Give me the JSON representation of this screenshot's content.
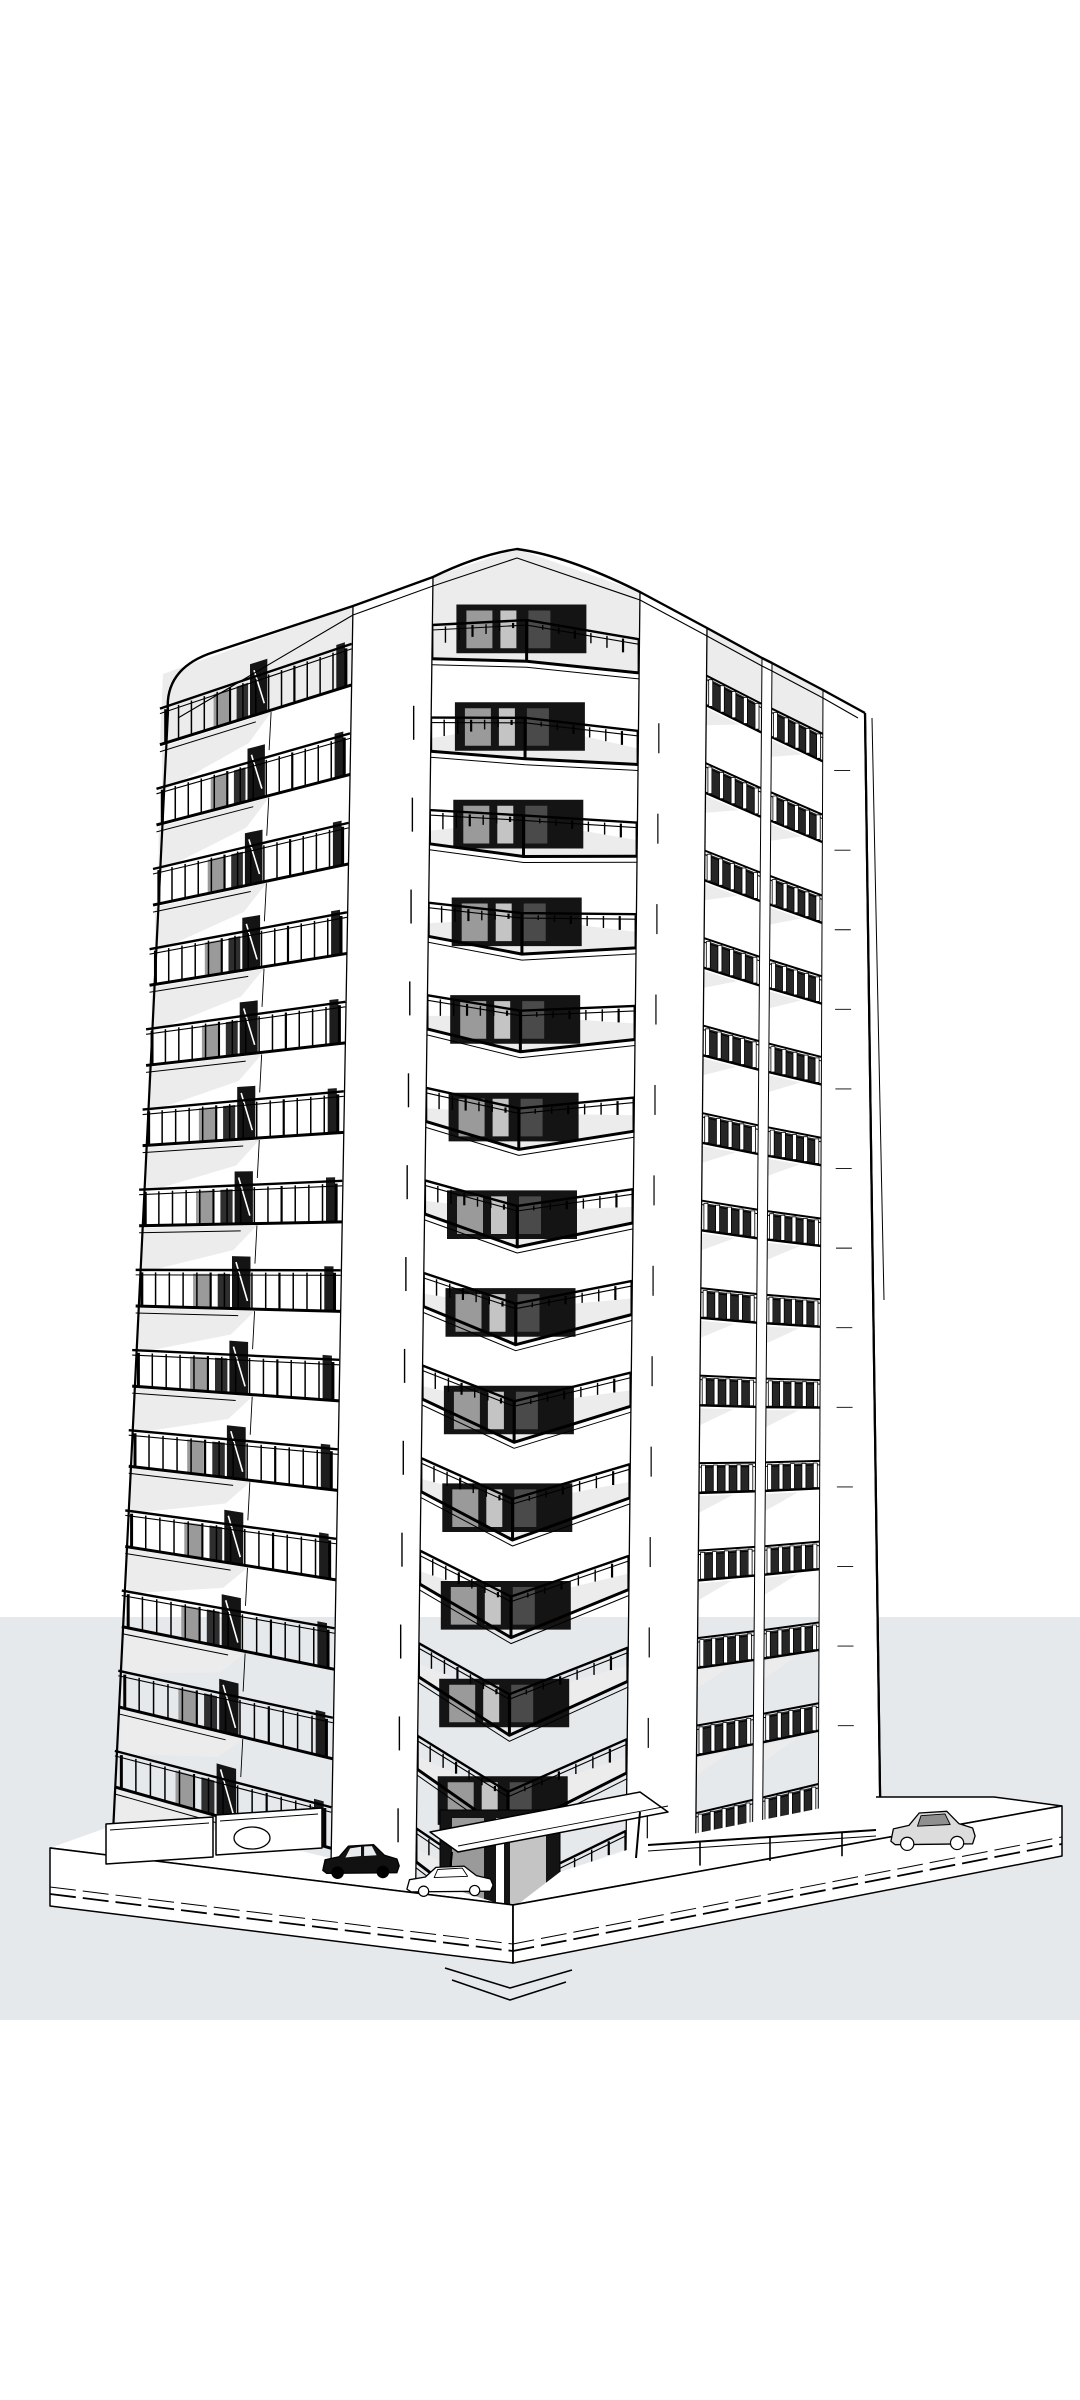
{
  "scene": {
    "canvas": {
      "w": 1080,
      "h": 2400
    },
    "colors": {
      "background": "#ffffff",
      "band": "#e5e9ec",
      "line": "#000000",
      "shade": "#ececec",
      "glass_light": "#9a9a9a",
      "glass_mid": "#c4c4c4",
      "glass_dark": "#4a4a4a",
      "window_black": "#141414",
      "backdrop_dark": "#262626",
      "car_dark": "#111111",
      "car_light": "#dcdcdc",
      "white": "#ffffff"
    },
    "band": {
      "top": 1617,
      "bottom": 2020
    },
    "floors": {
      "count": 14,
      "t0": 0.06,
      "dt": 0.068
    },
    "zones": {
      "A": {
        "top": [
          163,
          674
        ],
        "bot": [
          112,
          1853
        ]
      },
      "B": {
        "top": [
          353,
          606
        ],
        "bot": [
          330,
          1922
        ]
      },
      "C": {
        "top": [
          433,
          577
        ],
        "bot": [
          415,
          1938
        ]
      },
      "X": {
        "top": [
          528,
          549
        ],
        "bot": [
          505,
          1985
        ]
      },
      "D": {
        "top": [
          640,
          592
        ],
        "bot": [
          625,
          1940
        ]
      },
      "E": {
        "top": [
          707,
          628
        ],
        "bot": [
          695,
          1915
        ]
      },
      "F": {
        "top": [
          762,
          658
        ],
        "bot": [
          752,
          1898
        ]
      },
      "G": {
        "top": [
          772,
          663
        ],
        "bot": [
          762,
          1895
        ]
      },
      "H": {
        "top": [
          823,
          690
        ],
        "bot": [
          818,
          1878
        ]
      },
      "I": {
        "top": [
          865,
          713
        ],
        "bot": [
          881,
          1862
        ]
      }
    },
    "left_face": {
      "balusters": 15,
      "rail_h": 0.45,
      "pane": [
        0.28,
        0.36
      ],
      "dark_pane": [
        0.4,
        0.46
      ],
      "door": [
        0.47,
        0.56
      ],
      "sliver": [
        0.92,
        0.965
      ],
      "shade_u": 0.58,
      "joint_u": 0.58
    },
    "chevron": {
      "apex_drop": 26,
      "rail_h": 0.42,
      "side_rail": 0.82,
      "balusters": 6,
      "slab_lift": [
        13,
        36,
        16
      ],
      "window_w": 130
    },
    "right_face": {
      "rail_h": 0.34,
      "balusters": 5,
      "backdrop": [
        0.12,
        0.88
      ],
      "shade_u": 0.6
    },
    "parapet": {
      "path": "M 168 712 Q 164 668 214 652 L 353 606 L 433 577 Q 478 555 517 549 Q 568 556 640 592 L 707 628 L 762 658 L 772 663 L 823 690 L 865 713",
      "inner": [
        [
          178,
          718
        ],
        [
          353,
          615
        ],
        [
          433,
          586
        ],
        [
          517,
          558
        ],
        [
          640,
          600
        ],
        [
          707,
          636
        ],
        [
          762,
          666
        ],
        [
          772,
          671
        ],
        [
          823,
          698
        ],
        [
          858,
          718
        ]
      ],
      "roof_peak": [
        517,
        549
      ]
    },
    "edges": {
      "left": [
        [
          168,
          712
        ],
        [
          112,
          1853
        ]
      ],
      "right": [
        [
          865,
          713
        ],
        [
          881,
          1862
        ]
      ],
      "right_back": [
        [
          872,
          718
        ],
        [
          884,
          1300
        ]
      ]
    },
    "podium": {
      "top": [
        [
          50,
          1848
        ],
        [
          513,
          1905
        ],
        [
          1062,
          1806
        ]
      ],
      "bot": [
        [
          50,
          1906
        ],
        [
          513,
          1963
        ],
        [
          1062,
          1856
        ]
      ],
      "mask": [
        [
          50,
          1848
        ],
        [
          106,
          1828
        ],
        [
          213,
          1830
        ],
        [
          330,
          1858
        ],
        [
          440,
          1885
        ],
        [
          513,
          1908
        ],
        [
          560,
          1872
        ],
        [
          648,
          1843
        ],
        [
          876,
          1797
        ],
        [
          994,
          1797
        ],
        [
          1062,
          1806
        ],
        [
          513,
          1906
        ]
      ],
      "curb_offsets": [
        12,
        19
      ]
    },
    "ground_door": {
      "x": 440,
      "y": 1810,
      "w": 120,
      "h": 132
    },
    "walls_left": [
      [
        [
          106,
          1824
        ],
        [
          213,
          1817
        ],
        [
          213,
          1857
        ],
        [
          106,
          1864
        ]
      ],
      [
        [
          216,
          1815
        ],
        [
          322,
          1808
        ],
        [
          322,
          1848
        ],
        [
          216,
          1855
        ]
      ]
    ],
    "fence_right": {
      "a": [
        648,
        1845
      ],
      "b": [
        876,
        1830
      ],
      "posts": [
        700,
        770,
        842
      ],
      "drop": 24
    },
    "back_wall": [
      [
        876,
        1797
      ],
      [
        994,
        1797
      ],
      [
        1062,
        1806
      ]
    ],
    "canopy": {
      "quad": [
        [
          430,
          1832
        ],
        [
          640,
          1792
        ],
        [
          668,
          1812
        ],
        [
          458,
          1852
        ]
      ],
      "posts": [
        [
          640,
          1812,
          1858
        ],
        [
          452,
          1852,
          1892
        ]
      ]
    },
    "steps": [
      [
        [
          445,
          1968
        ],
        [
          510,
          1988
        ],
        [
          572,
          1970
        ]
      ],
      [
        [
          452,
          1980
        ],
        [
          510,
          2000
        ],
        [
          566,
          1982
        ]
      ]
    ],
    "bush": {
      "cx": 252,
      "cy": 1838,
      "rx": 18,
      "ry": 11
    },
    "cars": [
      {
        "name": "car-dark-sedan",
        "type": "dark",
        "x": 322,
        "y": 1840,
        "w": 78,
        "h": 38
      },
      {
        "name": "car-outline",
        "type": "outline",
        "x": 406,
        "y": 1862,
        "w": 88,
        "h": 34
      },
      {
        "name": "car-light-suv",
        "type": "light",
        "x": 890,
        "y": 1806,
        "w": 86,
        "h": 44
      }
    ]
  }
}
